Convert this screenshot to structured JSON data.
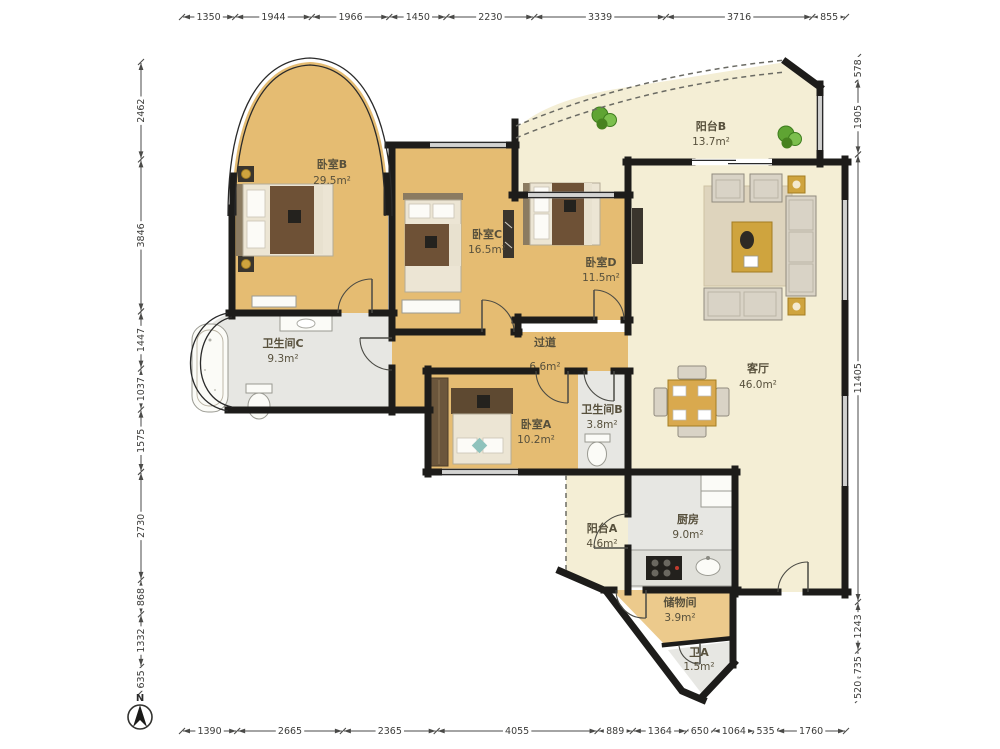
{
  "meta": {
    "compass_label": "N"
  },
  "rooms": [
    {
      "id": "bedroom-b",
      "name": "卧室B",
      "area": "29.5m²"
    },
    {
      "id": "bedroom-c",
      "name": "卧室C",
      "area": "16.5m²"
    },
    {
      "id": "bedroom-d",
      "name": "卧室D",
      "area": "11.5m²"
    },
    {
      "id": "balcony-b",
      "name": "阳台B",
      "area": "13.7m²"
    },
    {
      "id": "living-room",
      "name": "客厅",
      "area": "46.0m²"
    },
    {
      "id": "bathroom-c",
      "name": "卫生间C",
      "area": "9.3m²"
    },
    {
      "id": "hallway",
      "name": "过道",
      "area": "6.6m²"
    },
    {
      "id": "bedroom-a",
      "name": "卧室A",
      "area": "10.2m²"
    },
    {
      "id": "bathroom-b",
      "name": "卫生间B",
      "area": "3.8m²"
    },
    {
      "id": "balcony-a",
      "name": "阳台A",
      "area": "4.6m²"
    },
    {
      "id": "kitchen",
      "name": "厨房",
      "area": "9.0m²"
    },
    {
      "id": "storage",
      "name": "储物间",
      "area": "3.9m²"
    },
    {
      "id": "toilet-a",
      "name": "卫A",
      "area": "1.5m²"
    }
  ],
  "dimensions_mm": {
    "top": [
      1350,
      1944,
      1966,
      1450,
      2230,
      3339,
      3716,
      855
    ],
    "bottom": [
      1390,
      2665,
      2365,
      4055,
      889,
      1364,
      650,
      1064,
      535,
      1760
    ],
    "left": [
      2462,
      3846,
      1447,
      1037,
      1575,
      2730,
      868,
      1332,
      635
    ],
    "right": [
      578,
      1905,
      11405,
      1243,
      735,
      520
    ]
  },
  "colors": {
    "wall": "#1d1c1a",
    "wood_floor": "#e5bc72",
    "tile_floor": "#e7e7e3",
    "cream_floor": "#f4eed5",
    "accent_gold": "#cfa43e",
    "plant_green": "#5fa433",
    "dim_text": "#3c3c3a",
    "label_text": "#57503c"
  }
}
